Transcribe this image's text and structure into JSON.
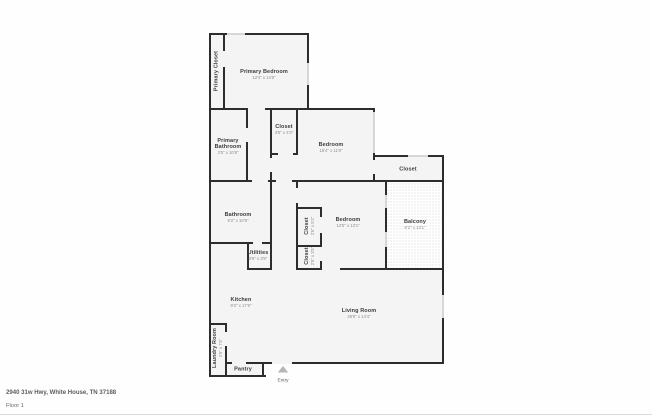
{
  "meta": {
    "address": "2940 31w Hwy, White House, TN 37188",
    "floor": "Floor 1"
  },
  "entry": {
    "label": "Entry"
  },
  "rooms": {
    "primary_closet": {
      "name": "Primary Closet"
    },
    "primary_bedroom": {
      "name": "Primary Bedroom",
      "dims": "12'4\" x 14'5\""
    },
    "primary_bathroom": {
      "name": "Primary Bathroom",
      "dims": "3'5\" x 10'8\""
    },
    "closet_hall": {
      "name": "Closet",
      "dims": "3'5\" x 4'3\""
    },
    "bedroom_top": {
      "name": "Bedroom",
      "dims": "15'4\" x 11'0\""
    },
    "closet_right": {
      "name": "Closet"
    },
    "bathroom": {
      "name": "Bathroom",
      "dims": "9'2\" x 10'6\""
    },
    "closet_mid_upper": {
      "name": "Closet",
      "dims": "2'6\" x 5'2\""
    },
    "closet_mid_lower": {
      "name": "Closet",
      "dims": "2'6\" x 3'5\""
    },
    "bedroom_mid": {
      "name": "Bedroom",
      "dims": "12'5\" x 13'1\""
    },
    "balcony": {
      "name": "Balcony",
      "dims": "8'2\" x 13'1\""
    },
    "utilities": {
      "name": "Utilities",
      "dims": "3'6\" x 3'9\""
    },
    "kitchen": {
      "name": "Kitchen",
      "dims": "9'2\" x 17'6\""
    },
    "living_room": {
      "name": "Living Room",
      "dims": "26'8\" x 14'4\""
    },
    "laundry_room": {
      "name": "Laundry Room",
      "dims": "2'6\" x 7'6\""
    },
    "pantry": {
      "name": "Pantry"
    }
  },
  "colors": {
    "wall": "#2d2d2d",
    "room_fill": "#f4f4f4",
    "window": "#d7d7d7",
    "balcony_dot": "#cccccc",
    "name_text": "#3c3c3c",
    "dims_text": "#8d8d8d"
  }
}
